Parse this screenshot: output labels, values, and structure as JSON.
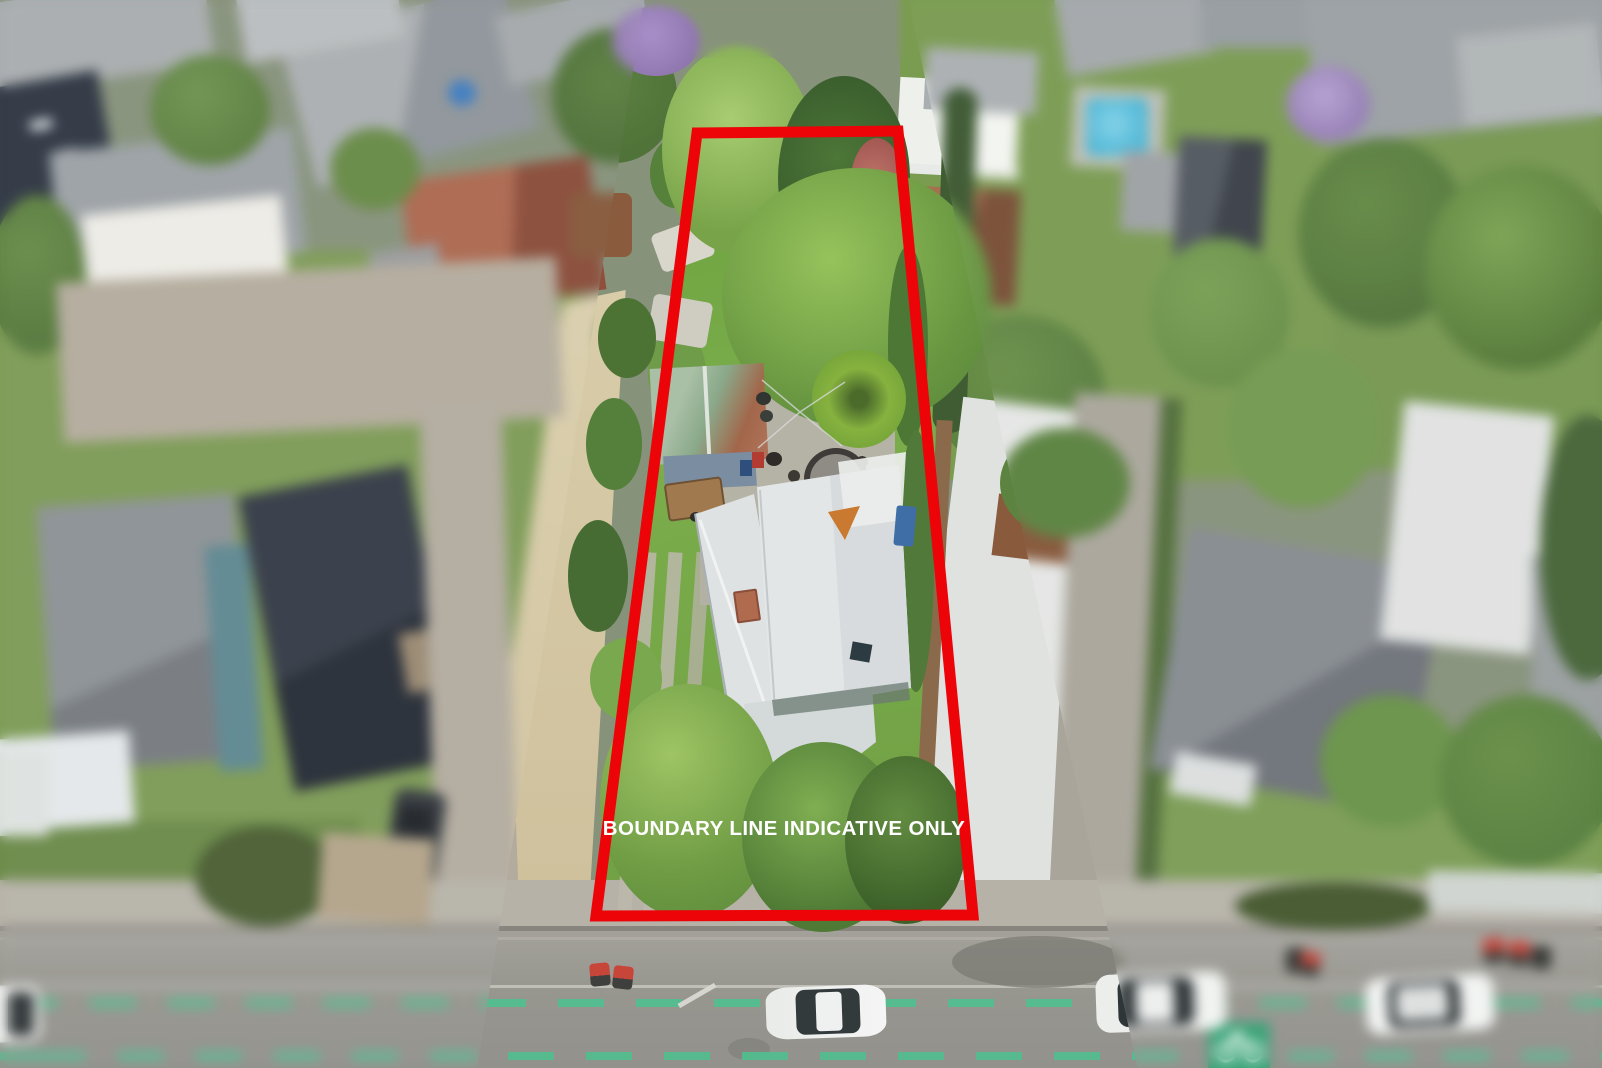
{
  "overlay": {
    "boundary_label": "BOUNDARY LINE INDICATIVE ONLY"
  },
  "boundary": {
    "points": "697,133 898,131 973,915 596,916",
    "stroke_width": "11"
  },
  "colors": {
    "boundary_red": "#ec0408",
    "label_white": "#ffffff",
    "bike_lane_green": "#4fbf8e",
    "lawn_green": "#74a14c",
    "roof_white": "#e2e5e6",
    "road_grey": "#9a9994",
    "sand_path": "#d3c6a4"
  }
}
